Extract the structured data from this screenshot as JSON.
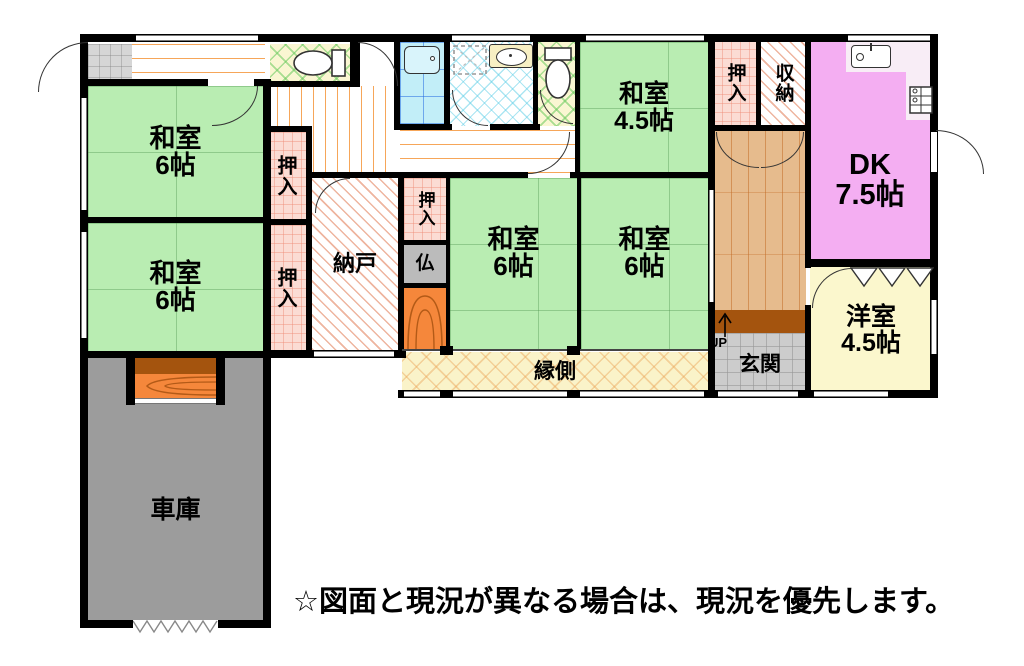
{
  "plan_title": "1F間取り図",
  "rooms": {
    "washitsu_nw": {
      "label": "和室",
      "size": "6帖"
    },
    "washitsu_w": {
      "label": "和室",
      "size": "6帖"
    },
    "washitsu_c1": {
      "label": "和室",
      "size": "6帖"
    },
    "washitsu_c2": {
      "label": "和室",
      "size": "6帖"
    },
    "washitsu_45": {
      "label": "和室",
      "size": "4.5帖"
    },
    "dk": {
      "label": "DK",
      "size": "7.5帖"
    },
    "yoshitsu_45": {
      "label": "洋室",
      "size": "4.5帖"
    },
    "nando": {
      "label": "納戸"
    },
    "engawa": {
      "label": "縁側"
    },
    "genkan": {
      "label": "玄関"
    },
    "shako": {
      "label": "車庫"
    },
    "oshiire": {
      "label": "押入"
    },
    "shuno": {
      "label": "収納"
    },
    "butsuma": {
      "label": "仏"
    }
  },
  "stairs": {
    "label": "UP"
  },
  "notice": "☆図面と現況が異なる場合は、現況を優先します。",
  "colors": {
    "tatami_green": "#b9edb2",
    "closet_pink": "#fbdcd4",
    "dk_pink": "#f4aef2",
    "yoshitsu_yellow": "#fbf7cd",
    "engawa_yellow": "#faf3c9",
    "garage_gray": "#9c9c9c",
    "genkan_gray": "#cccccc",
    "hall_wood": "#e6bb8d",
    "step_brown": "#a4540e",
    "tokonoma_orange": "#f5873b",
    "bath_cyan": "#c2eef8",
    "wall": "#000000"
  }
}
